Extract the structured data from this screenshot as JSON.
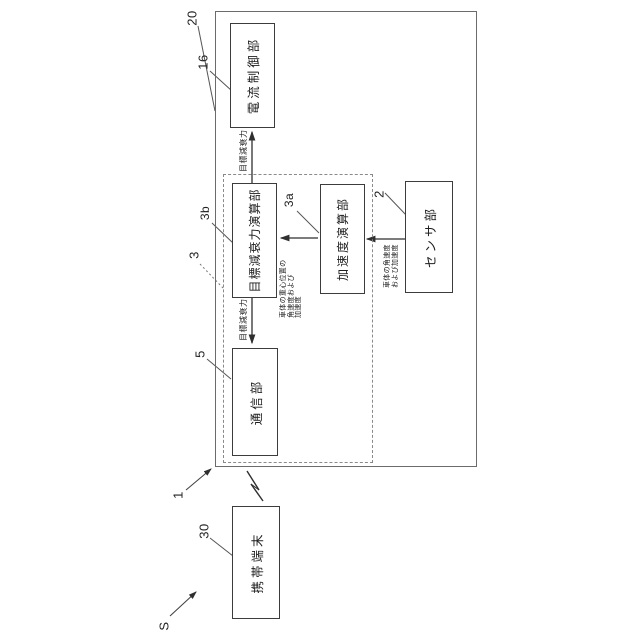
{
  "figure": {
    "refs": {
      "system": "S",
      "device": "1",
      "control_unit": "20",
      "current_control": "16",
      "controller": "3",
      "target_damping": "3b",
      "acceleration": "3a",
      "sensor": "2",
      "communication": "5",
      "mobile_terminal": "30"
    },
    "boxes": {
      "current_control": "電流制御部",
      "target_damping": "目標減衰力演算部",
      "acceleration": "加速度演算部",
      "communication": "通信部",
      "sensor": "センサ部",
      "mobile_terminal": "携帯端末"
    },
    "signals": {
      "target_damping_force_to_current": "目標減衰力",
      "target_damping_force_to_comm": "目標減衰力",
      "cog_motion": [
        "車体の重心位置の",
        "角速度および",
        "加速度"
      ],
      "body_motion": [
        "車体の角速度",
        "および加速度"
      ]
    },
    "line_color": "#3a3a3a",
    "leader_color": "#555555"
  }
}
